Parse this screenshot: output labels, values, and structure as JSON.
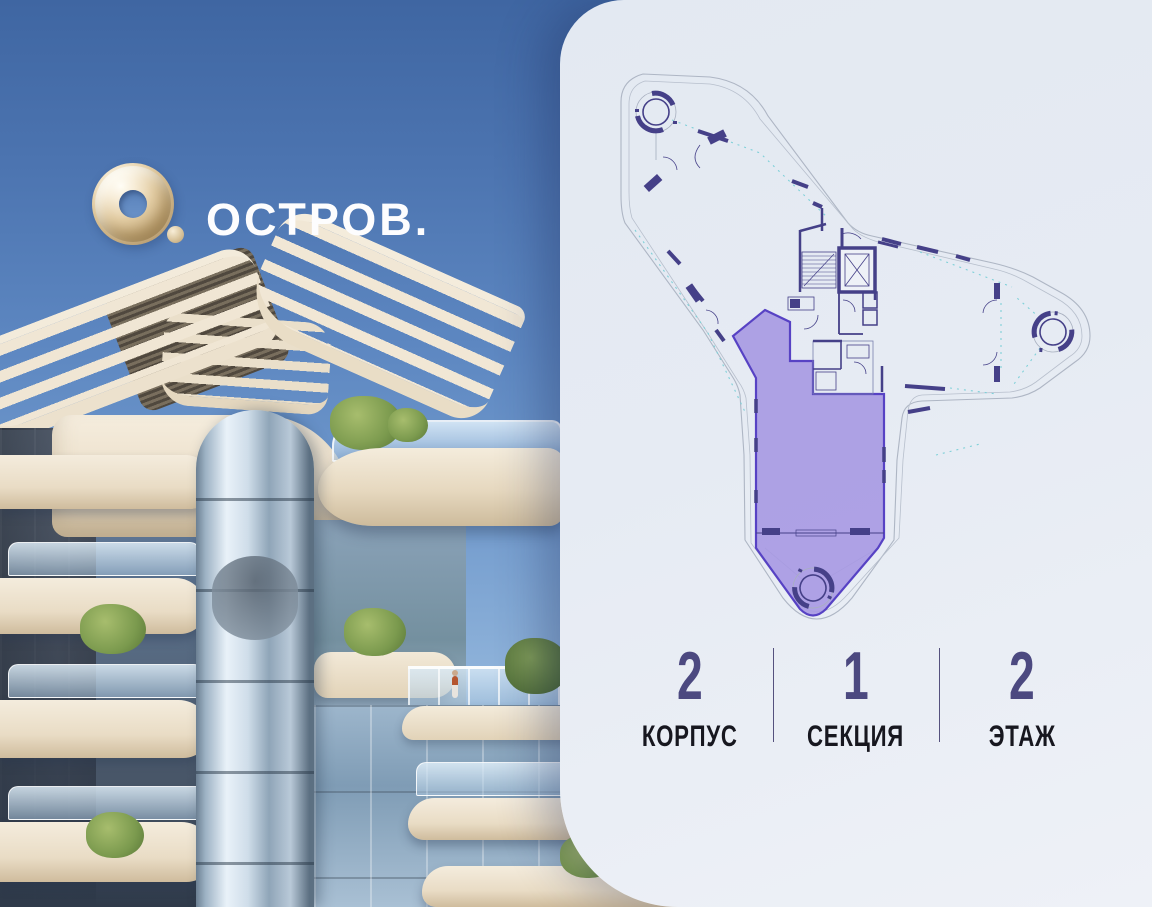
{
  "brand": {
    "wordmark": "ОСТРОВ.",
    "logo_icon": "gold-torus-icon"
  },
  "floorplan": {
    "type": "apartment-floor-plan",
    "highlighted_unit": {
      "building": "2",
      "section": "1",
      "floor": "2"
    },
    "colors": {
      "highlight_fill": "#a89ae3",
      "highlight_stroke": "#5742c4",
      "walls": "#454088",
      "outline": "#aeb6c4",
      "glass_lines": "#7fd0d8",
      "panel_background": "#e6ebf3"
    }
  },
  "stats": {
    "items": [
      {
        "value": "2",
        "label": "КОРПУС"
      },
      {
        "value": "1",
        "label": "СЕКЦИЯ"
      },
      {
        "value": "2",
        "label": "ЭТАЖ"
      }
    ],
    "value_color": "#4c4980",
    "label_color": "#17171f"
  },
  "scene": {
    "sky_color": "#5d87c1",
    "building_color": "#ece1cd"
  }
}
